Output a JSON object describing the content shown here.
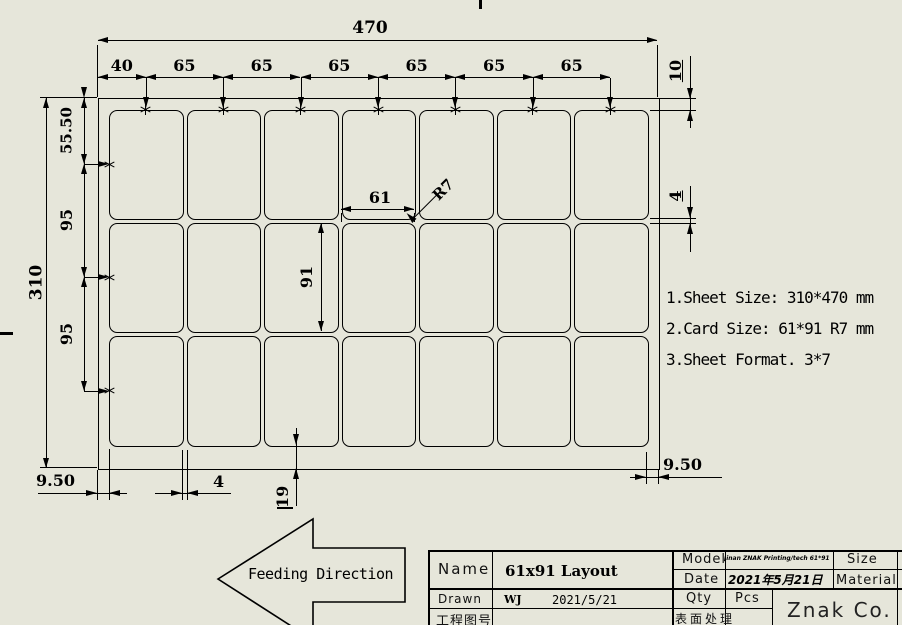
{
  "colors": {
    "background": "#e6e6da",
    "line": "#000000"
  },
  "drawing": {
    "format": {
      "rows": 3,
      "cols": 7
    },
    "margins": {
      "first_center_mm": 40,
      "pitch_mm": 65,
      "row_first_center_mm": 55.5,
      "row_pitch_mm": 95,
      "top_mm": 10,
      "left_mm": 9.5,
      "card_w_mm": 61,
      "card_h_mm": 91,
      "radius_mm": 7
    },
    "col_segment_labels": [
      "40",
      "65",
      "65",
      "65",
      "65",
      "65",
      "65"
    ],
    "dim_labels": {
      "sheet_width": "470",
      "sheet_height": "310",
      "row_first": "55.50",
      "row_pitch_a": "95",
      "row_pitch_b": "95",
      "card_width": "61",
      "card_height": "91",
      "corner_radius": "R7",
      "margin_top": "10",
      "gap_right": "4",
      "gap_bottom": "4",
      "margin_left": "9.50",
      "margin_right": "9.50",
      "margin_bottom": "19"
    }
  },
  "notes": {
    "lines": [
      "1.Sheet Size: 310*470 mm",
      "2.Card Size: 61*91 R7 mm",
      "3.Sheet Format. 3*7"
    ]
  },
  "feeding": {
    "label": "Feeding Direction"
  },
  "title_block": {
    "name_label": "Name",
    "name_value": "61x91 Layout",
    "drawn_label": "Drawn",
    "drawn_value": "WJ",
    "drawn_date": "2021/5/21",
    "project_no_label": "工程图号",
    "model_label": "Model",
    "model_value": "Jinan ZNAK Printing/tech 61*91",
    "size_label": "Size",
    "date_label": "Date",
    "date_value": "2021年5月21日",
    "material_label": "Material",
    "qty_label": "Qty",
    "qty_unit": "Pcs",
    "surface_label": "表面处理",
    "company": "Znak Co."
  }
}
